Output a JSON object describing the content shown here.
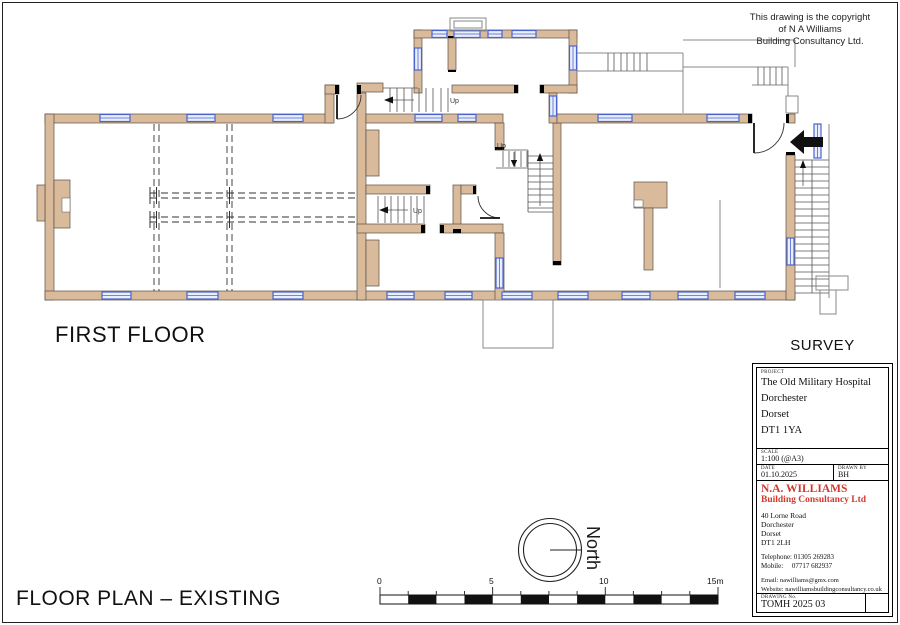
{
  "page": {
    "copyright_lines": [
      "This drawing is the copyright",
      "of N A Williams",
      "Building Consultancy Ltd."
    ],
    "floor_label": "FIRST FLOOR",
    "survey_label": "SURVEY",
    "plan_title": "FLOOR PLAN – EXISTING"
  },
  "plan": {
    "up_label": "Up"
  },
  "north": {
    "label": "North"
  },
  "scale_bar": {
    "t0": "0",
    "t5": "5",
    "t10": "10",
    "t15": "15m"
  },
  "title_block": {
    "project_label": "PROJECT",
    "project_lines": [
      "The Old Military Hospital",
      "Dorchester",
      "Dorset",
      "DT1 1YA"
    ],
    "scale_label": "SCALE",
    "scale_value": "1:100 (@A3)",
    "date_label": "DATE",
    "date_value": "01.10.2025",
    "drawn_by_label": "DRAWN BY",
    "drawn_by_value": "BH",
    "company_name": "N.A. WILLIAMS",
    "company_sub": "Building Consultancy Ltd",
    "address_lines": [
      "40 Lorne Road",
      "Dorchester",
      "Dorset",
      "DT1 2LH"
    ],
    "telephone": "Telephone: 01305 269283",
    "mobile": "Mobile:     07717 682937",
    "email": "Email: nawilliams@gmx.com",
    "website": "Website: nawilliamsbuildingconsultancy.co.uk",
    "drawing_no_label": "DRAWING No.",
    "drawing_no_value": "TOMH 2025 03"
  },
  "colors": {
    "wall_fill": "#d9bb9b",
    "window_blue": "#4a63cf",
    "window_fill": "#e9effc",
    "accent_red": "#d2382c"
  }
}
